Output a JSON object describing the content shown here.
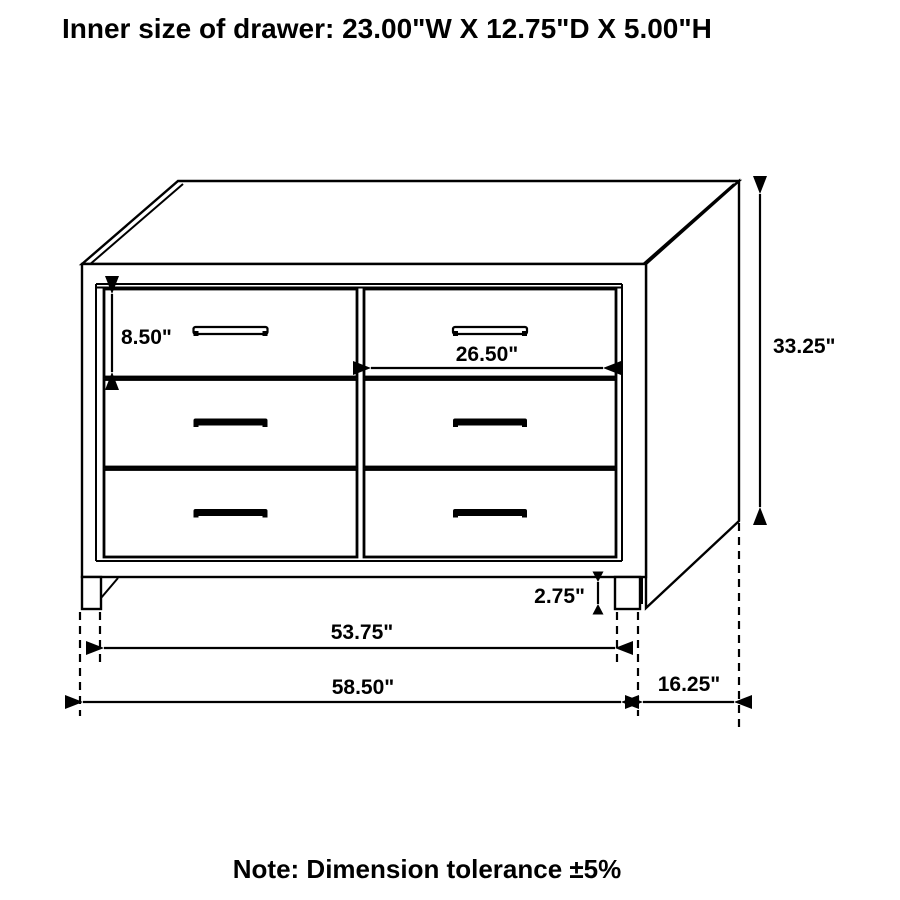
{
  "title": "Inner size of drawer: 23.00\"W X 12.75\"D X 5.00\"H",
  "note": "Note: Dimension tolerance ±5%",
  "dimensions": {
    "drawer_front_height": "8.50\"",
    "drawer_front_width": "26.50\"",
    "overall_height": "33.25\"",
    "base_height": "2.75\"",
    "width_between_legs": "53.75\"",
    "overall_width": "58.50\"",
    "overall_depth": "16.25\""
  },
  "colors": {
    "line": "#000000",
    "text": "#000000",
    "background": "#ffffff"
  }
}
